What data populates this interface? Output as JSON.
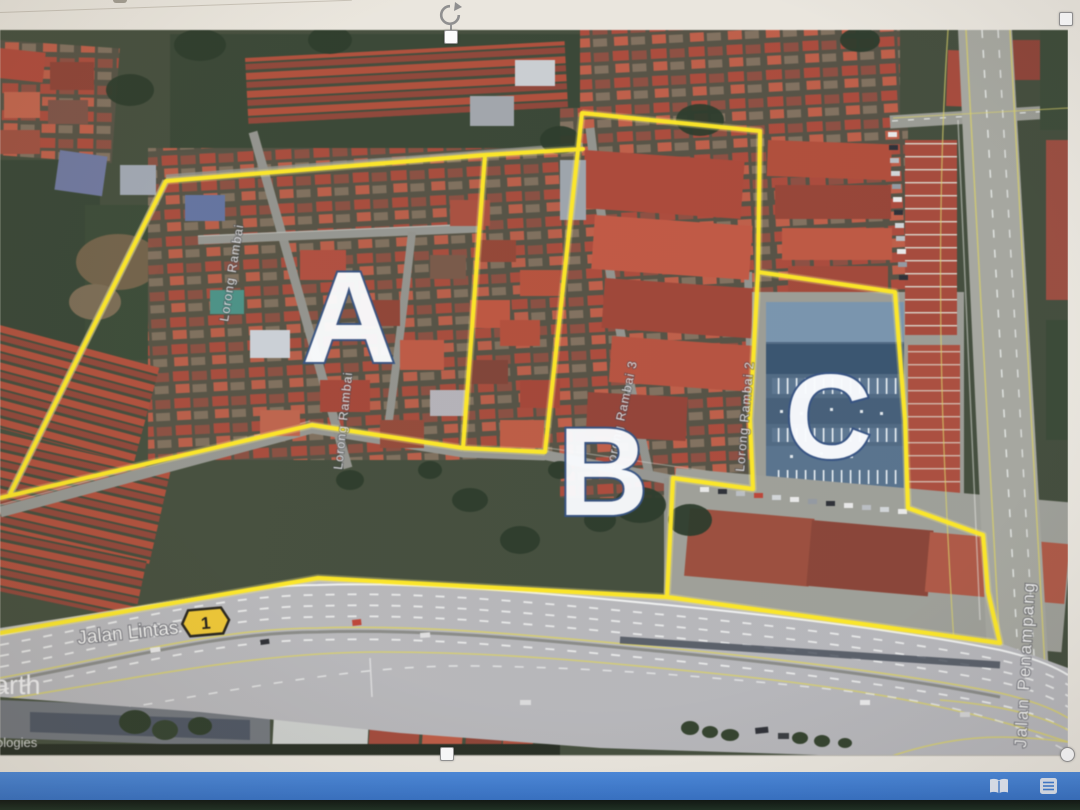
{
  "map": {
    "areas": [
      {
        "label": "A"
      },
      {
        "label": "B"
      },
      {
        "label": "C"
      }
    ],
    "roads": {
      "jalan_lintas": "Jalan Lintas",
      "route_shield": "1",
      "jalan_penampang": "Jalan Penampang",
      "street_labels": [
        "Lorong Rambai",
        "Lorong Rambai",
        "Lorong Rambai 3",
        "Lorong Rambai 2"
      ]
    },
    "watermark_fragment": "arth",
    "credit_fragment": "ologies",
    "highlight_color": "#ffe60a"
  },
  "app": {
    "selection_handles": [
      "rotate",
      "top-middle",
      "top-right",
      "bottom-middle",
      "bottom-right"
    ],
    "status_bar": {
      "color": "#3a79d0",
      "icons": [
        {
          "name": "book-open-view"
        },
        {
          "name": "grid-view"
        }
      ]
    }
  }
}
